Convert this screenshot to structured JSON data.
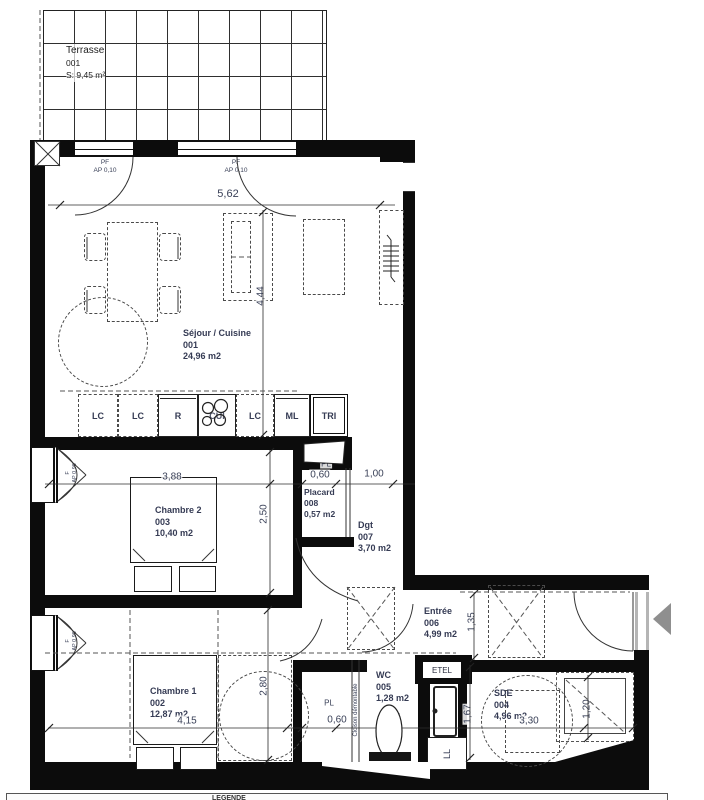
{
  "terrace": {
    "name": "Terrasse",
    "number": "001",
    "area": "S: 9,45 m²"
  },
  "rooms": [
    {
      "name": "Séjour / Cuisine",
      "number": "001",
      "area": "24,96 m2"
    },
    {
      "name": "Chambre 1",
      "number": "002",
      "area": "12,87 m2"
    },
    {
      "name": "Chambre 2",
      "number": "003",
      "area": "10,40 m2"
    },
    {
      "name": "SDE",
      "number": "004",
      "area": "4,96 m2"
    },
    {
      "name": "WC",
      "number": "005",
      "area": "1,28 m2"
    },
    {
      "name": "Entrée",
      "number": "006",
      "area": "4,99 m2"
    },
    {
      "name": "Dgt",
      "number": "007",
      "area": "3,70 m2"
    },
    {
      "name": "Placard",
      "number": "008",
      "area": "0,57 m2"
    }
  ],
  "kitchen": {
    "units": [
      "LC",
      "LC",
      "R",
      "CUI",
      "LC",
      "ML",
      "TRI"
    ]
  },
  "openings": {
    "pf": {
      "code": "PF",
      "ap": "AP 0,10"
    },
    "f": {
      "code": "F",
      "ap": "AP 0,90"
    }
  },
  "fixtures": {
    "etel": "ETEL",
    "ll": "LL",
    "pl": "PL",
    "cloison": "Cloison démontable"
  },
  "dimensions": {
    "living_w": "5,62",
    "living_d": "4,44",
    "ch2_w": "3,88",
    "ch2_d": "2,50",
    "placard_w": "0,60",
    "dgt_w": "1,00",
    "ch1_w": "4,15",
    "ch1_d": "2,80",
    "closet_w": "0,60",
    "wc_w": "1,05",
    "entree_d": "1,35",
    "sde_d": "1,67",
    "sde_w": "3,30",
    "shower_w": "1,20"
  },
  "legend": {
    "title": "LEGENDE"
  }
}
